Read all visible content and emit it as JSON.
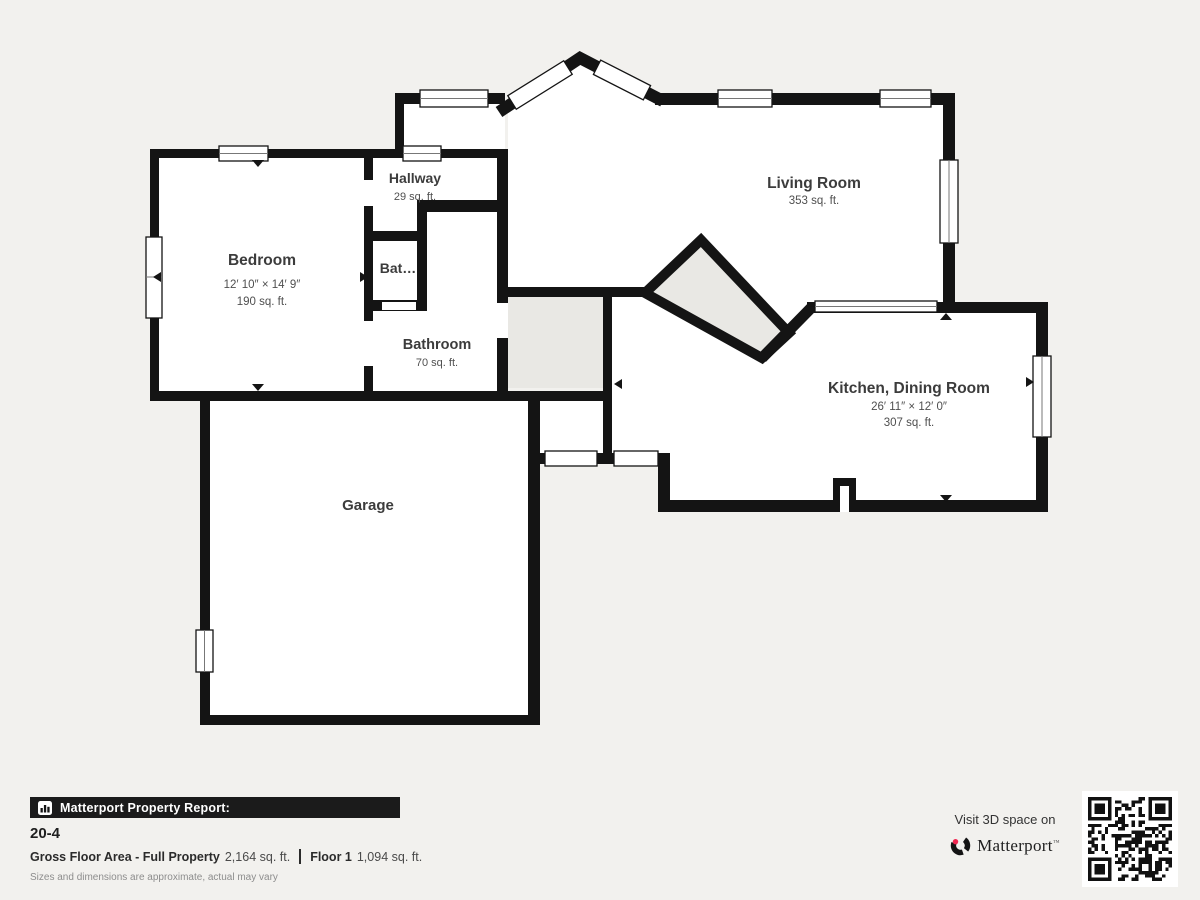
{
  "colors": {
    "background": "#f2f1ee",
    "wall": "#141414",
    "stairs_fill": "#e9e8e4",
    "room_text": "#3c3c3c",
    "brand_pink": "#f0254f",
    "footer_bar_bg": "#1b1b1b"
  },
  "plan": {
    "rooms": [
      {
        "id": "bedroom",
        "name": "Bedroom",
        "dims": "12′ 10″ × 14′ 9″",
        "area": "190 sq. ft."
      },
      {
        "id": "hallway",
        "name": "Hallway",
        "area": "29 sq. ft."
      },
      {
        "id": "bat",
        "name": "Bat…"
      },
      {
        "id": "bathroom",
        "name": "Bathroom",
        "area": "70 sq. ft."
      },
      {
        "id": "living-room",
        "name": "Living Room",
        "area": "353 sq. ft."
      },
      {
        "id": "kitchen-dining",
        "name": "Kitchen, Dining Room",
        "dims": "26′ 11″ × 12′ 0″",
        "area": "307 sq. ft."
      },
      {
        "id": "garage",
        "name": "Garage"
      }
    ]
  },
  "footer": {
    "report_label": "Matterport Property Report:",
    "property_id": "20-4",
    "gross_label": "Gross Floor Area - Full Property",
    "gross_value": "2,164 sq. ft.",
    "floor_label": "Floor 1",
    "floor_value": "1,094 sq. ft.",
    "disclaimer": "Sizes and dimensions are approximate, actual may vary",
    "visit_text": "Visit 3D space on",
    "brand": "Matterport"
  }
}
